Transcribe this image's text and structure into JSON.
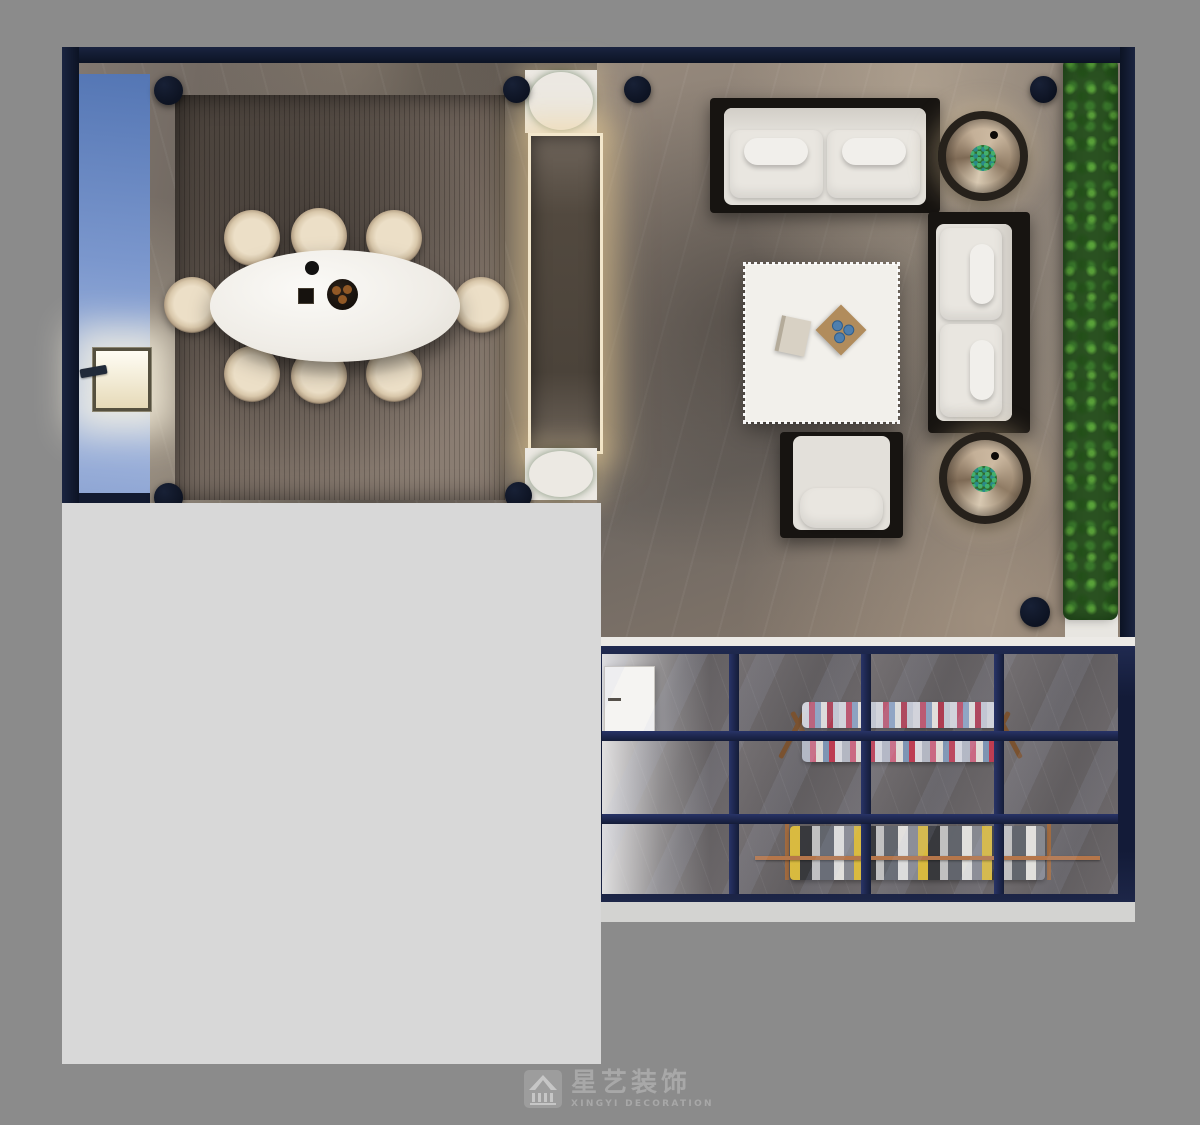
{
  "watermark": {
    "icon": "house-logo-icon",
    "brand_cn": "星艺装饰",
    "brand_en": "XINGYI DECORATION",
    "text_color": "#a8a8a8"
  },
  "palette": {
    "outer_background": "#8b8b8b",
    "unrendered_area": "#d8d8d8",
    "wall_navy": "#121a31",
    "glass_frame_navy": "#1b2445",
    "blue_accent_wall": "#7b97cd",
    "wood_deck": "#6b5f55",
    "marble_floor_gray": "#7d746d",
    "sofa_cushion_white": "#e4e1db",
    "furniture_frame_black": "#171411",
    "table_white": "#f2f0eb",
    "plant_green": "#3f7c2e",
    "warm_accent_light": "#ecd9ad"
  }
}
